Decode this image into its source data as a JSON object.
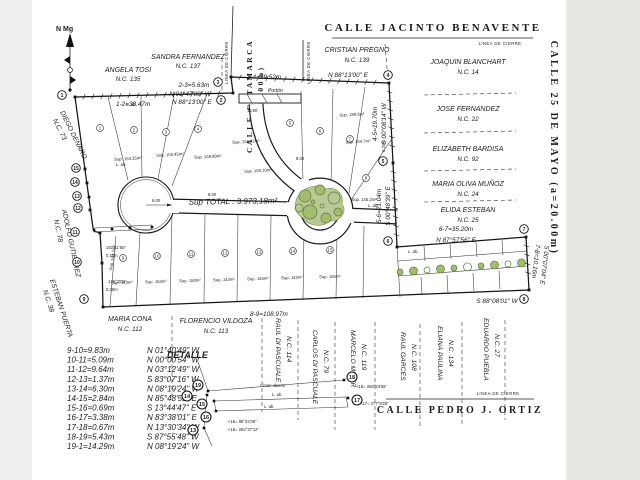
{
  "north": {
    "label": "N Mg"
  },
  "streets": {
    "top": "CALLE JACINTO BENAVENTE",
    "catamarca": "CALLE CATAMARCA",
    "catamarca_width": "(a=20.00m)",
    "right": "CALLE 25 DE MAYO  (a=20.00m)",
    "bottom": "CALLE PEDRO J. ORTIZ"
  },
  "labels": {
    "linea_de_cierre": "LINEA DE CIERRE",
    "sup_total": "Sup TOTAL : 3.973,18m²",
    "detalle": "DETALLE",
    "porton": "Portón",
    "porton_width": "16.00",
    "radius": "6.00",
    "road_width": "8.00",
    "l_ab": "L. ab."
  },
  "detail": {
    "limite_abierto": "Límite abierto",
    "angles": [
      "<18= 258°23'55\"",
      "<17= 277°8'25\"",
      "<15= 98°33'36\"",
      "<16= 262°37'12\""
    ]
  },
  "edge_labels": [
    "183°11'55\"",
    "0.10m",
    "179°20'5\"",
    "0.20m",
    "0.25m"
  ],
  "neighbors": [
    {
      "name": "ANGELA TOSI",
      "nc": "N.C. 135"
    },
    {
      "name": "SANDRA FERNANDEZ",
      "nc": "N.C. 137"
    },
    {
      "name": "CRISTIAN PREGNO",
      "nc": "N.C. 139"
    },
    {
      "name": "JOAQUIN BLANCHART",
      "nc": "N.C. 14"
    },
    {
      "name": "JOSE FERNANDEZ",
      "nc": "N.C. 22"
    },
    {
      "name": "ELIZABETH BARDISA",
      "nc": "N.C. 92"
    },
    {
      "name": "MARIA OLIVA MUÑOZ",
      "nc": "N.C. 24"
    },
    {
      "name": "ELIDA ESTEBAN",
      "nc": "N.C. 25"
    },
    {
      "name": "DIEGO DENARO",
      "nc": "N.C. 73"
    },
    {
      "name": "ADOLFO GUTIERREZ",
      "nc": "N.C. 78"
    },
    {
      "name": "ESTEBAN PUERTA",
      "nc": "N.C. 38"
    },
    {
      "name": "MARIA CONA",
      "nc": "N.C. 112"
    },
    {
      "name": "FLORENCIO VILDOZA",
      "nc": "N.C. 113"
    },
    {
      "name": "RAUL DI PASCUALE",
      "nc": "N.C. 114"
    },
    {
      "name": "CARLOS DI PASCUALE",
      "nc": "N.C. 79"
    },
    {
      "name": "MARCELO MINER",
      "nc": "N.C. 119"
    },
    {
      "name": "RAUL GARCES",
      "nc": "N.C. 108"
    },
    {
      "name": "ELIANA PAULINA",
      "nc": "N.C. 134"
    },
    {
      "name": "EDUARDO PUEBLA",
      "nc": "N.C. 27"
    }
  ],
  "dims": [
    {
      "seg": "1-2=38.47m",
      "bearing": "N 88°13'00\" E"
    },
    {
      "seg": "2-3=5.63m",
      "bearing": "N 01°47'00\" W"
    },
    {
      "seg": "3-4=39.52m",
      "bearing": "N 88°13'00\" E"
    },
    {
      "seg": "4-5=19.70m",
      "bearing": "S 00°08'14\" W"
    },
    {
      "seg": "5-6=21.04m",
      "bearing": "S 00°48'39\" E"
    },
    {
      "seg": "6-7=35.20m",
      "bearing": "N 87°57'56\" E"
    },
    {
      "seg": "7-8=10.16m",
      "bearing": "S 00°07'04\" E"
    },
    {
      "seg": "8-9=108.97m",
      "bearing": "S 88°08'01\" W"
    }
  ],
  "courses": [
    {
      "seg": "9-10=9.83m",
      "brg": "N 01°40'49\" W"
    },
    {
      "seg": "10-11=5.09m",
      "brg": "N 00°00'54\" W"
    },
    {
      "seg": "11-12=9.64m",
      "brg": "N 03°12'49\" W"
    },
    {
      "seg": "12-13=1.37m",
      "brg": "S 83°07'16\" W"
    },
    {
      "seg": "13-14=6.30m",
      "brg": "N 08°19'24\" W"
    },
    {
      "seg": "14-15=2.84m",
      "brg": "N 85°48'51\" E"
    },
    {
      "seg": "15-16=0.69m",
      "brg": "S 13°44'47\" E"
    },
    {
      "seg": "16-17=3.38m",
      "brg": "N 83°38'01\" E"
    },
    {
      "seg": "17-18=0.67m",
      "brg": "N 13°30'34\" W"
    },
    {
      "seg": "18-19=5.43m",
      "brg": "S 87°55'48\" W"
    },
    {
      "seg": "19-1=14.29m",
      "brg": "N 08°19'24\" W"
    }
  ],
  "survey_points": [
    {
      "n": "1",
      "cx": 62,
      "cy": 95,
      "dx": 75,
      "dy": 97
    },
    {
      "n": "2",
      "cx": 221,
      "cy": 100,
      "dx": 233,
      "dy": 93
    },
    {
      "n": "3",
      "cx": 218,
      "cy": 82,
      "dx": 231,
      "dy": 77
    },
    {
      "n": "4",
      "cx": 388,
      "cy": 75,
      "dx": 389,
      "dy": 83
    },
    {
      "n": "5",
      "cx": 383,
      "cy": 161,
      "dx": 393,
      "dy": 163
    },
    {
      "n": "6",
      "cx": 388,
      "cy": 241,
      "dx": 397,
      "dy": 247
    },
    {
      "n": "7",
      "cx": 524,
      "cy": 229,
      "dx": 526,
      "dy": 237
    },
    {
      "n": "8",
      "cx": 524,
      "cy": 299,
      "dx": 529,
      "dy": 290
    },
    {
      "n": "9",
      "cx": 84,
      "cy": 299,
      "dx": 103,
      "dy": 307
    },
    {
      "n": "10",
      "cx": 77,
      "cy": 262,
      "dx": 102,
      "dy": 263
    },
    {
      "n": "11",
      "cx": 75,
      "cy": 232,
      "dx": 100,
      "dy": 233
    },
    {
      "n": "12",
      "cx": 78,
      "cy": 208,
      "dx": 90,
      "dy": 210
    },
    {
      "n": "13",
      "cx": 77,
      "cy": 196,
      "dx": 89,
      "dy": 197
    },
    {
      "n": "14",
      "cx": 75,
      "cy": 182,
      "dx": 87,
      "dy": 183
    },
    {
      "n": "15",
      "cx": 76,
      "cy": 168,
      "dx": 85,
      "dy": 169
    }
  ],
  "detail_points": [
    {
      "n": "19",
      "x": 198,
      "y": 385,
      "dx": 208,
      "dy": 391
    },
    {
      "n": "14",
      "x": 187,
      "y": 396,
      "dx": 207,
      "dy": 395
    },
    {
      "n": "18",
      "x": 352,
      "y": 377,
      "dx": 344,
      "dy": 380
    },
    {
      "n": "15",
      "x": 202,
      "y": 404,
      "dx": 214,
      "dy": 401
    },
    {
      "n": "16",
      "x": 206,
      "y": 417,
      "dx": 216,
      "dy": 411
    },
    {
      "n": "17",
      "x": 357,
      "y": 400,
      "dx": 348,
      "dy": 398
    },
    {
      "n": "13",
      "x": 193,
      "y": 430,
      "dx": 204,
      "dy": 428
    }
  ],
  "lot_numbers": [
    {
      "n": "1",
      "x": 100,
      "y": 128
    },
    {
      "n": "2",
      "x": 134,
      "y": 130
    },
    {
      "n": "3",
      "x": 166,
      "y": 132
    },
    {
      "n": "4",
      "x": 198,
      "y": 129
    },
    {
      "n": "5",
      "x": 290,
      "y": 123
    },
    {
      "n": "6",
      "x": 320,
      "y": 131
    },
    {
      "n": "7",
      "x": 350,
      "y": 139
    },
    {
      "n": "8",
      "x": 366,
      "y": 178
    },
    {
      "n": "9",
      "x": 123,
      "y": 258
    },
    {
      "n": "10",
      "x": 157,
      "y": 256
    },
    {
      "n": "11",
      "x": 191,
      "y": 254
    },
    {
      "n": "12",
      "x": 225,
      "y": 253
    },
    {
      "n": "13",
      "x": 259,
      "y": 252
    },
    {
      "n": "14",
      "x": 293,
      "y": 251
    },
    {
      "n": "15",
      "x": 330,
      "y": 250
    }
  ],
  "sup_labels": [
    {
      "t": "Sup. 153.25m²",
      "x": 128,
      "y": 160,
      "r": -3
    },
    {
      "t": "Sup. 150.45m²",
      "x": 170,
      "y": 156,
      "r": -3
    },
    {
      "t": "Sup. 159.80m²",
      "x": 208,
      "y": 158,
      "r": -3
    },
    {
      "t": "Sup. 156.72m²",
      "x": 246,
      "y": 143,
      "r": -3
    },
    {
      "t": "Sup. 150.10m²",
      "x": 258,
      "y": 172,
      "r": -3
    },
    {
      "t": "Sup. 190.5m²",
      "x": 352,
      "y": 116,
      "r": -3
    },
    {
      "t": "Sup. 154.7m²",
      "x": 358,
      "y": 143,
      "r": -3
    },
    {
      "t": "Sup. 145.2m²",
      "x": 364,
      "y": 201,
      "r": 0
    },
    {
      "t": "Sup. 167.2m²",
      "x": 114,
      "y": 258,
      "r": -80
    },
    {
      "t": "Sup. 140m²",
      "x": 122,
      "y": 284,
      "r": -2
    },
    {
      "t": "Sup. 153m²",
      "x": 156,
      "y": 283,
      "r": -2
    },
    {
      "t": "Sup. 150m²",
      "x": 190,
      "y": 282,
      "r": -2
    },
    {
      "t": "Sup. 143m²",
      "x": 224,
      "y": 281,
      "r": -2
    },
    {
      "t": "Sup. 145m²",
      "x": 258,
      "y": 280,
      "r": -2
    },
    {
      "t": "Sup. 142m²",
      "x": 292,
      "y": 279,
      "r": -2
    },
    {
      "t": "Sup. 165m²",
      "x": 330,
      "y": 278,
      "r": -2
    }
  ]
}
